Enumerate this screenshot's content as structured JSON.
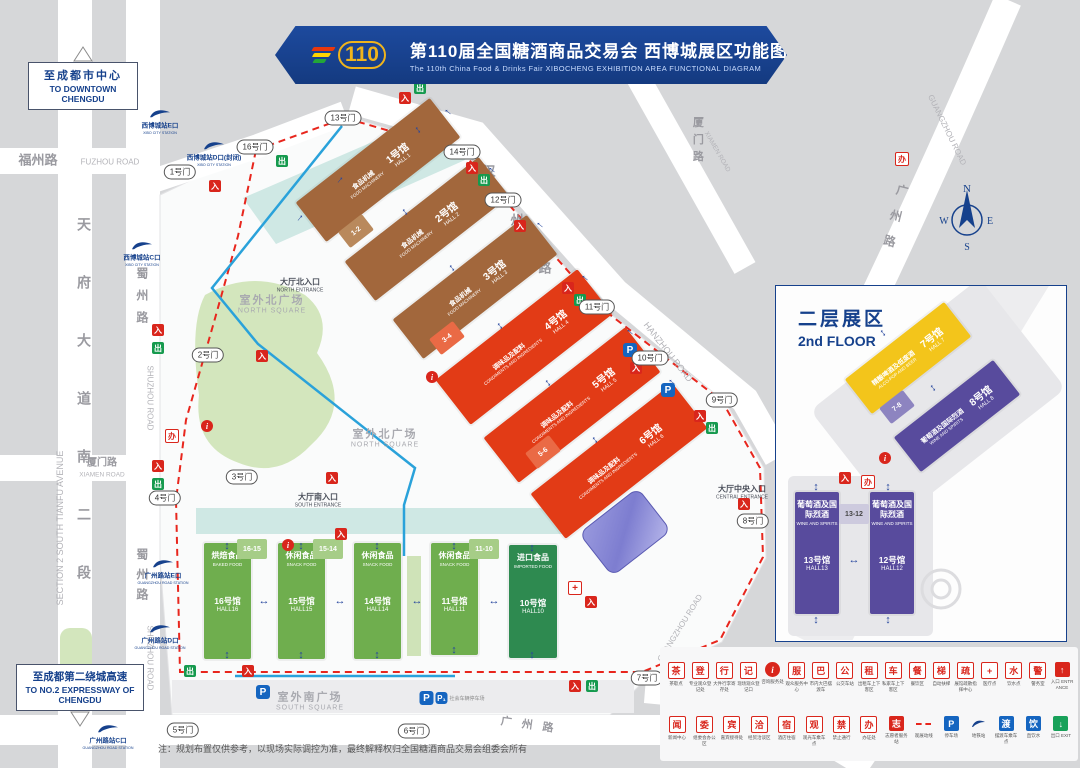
{
  "title": {
    "logo": "110",
    "cn": "第110届全国糖酒商品交易会 西博城展区功能图",
    "en": "The 110th China Food & Drinks Fair  XIBOCHENG EXHIBITION AREA FUNCTIONAL DIAGRAM"
  },
  "callouts": {
    "downtown": {
      "cn": "至成都市中心",
      "en": "TO DOWNTOWN CHENGDU"
    },
    "expressway": {
      "cn": "至成都第二绕城高速",
      "en": "TO NO.2 EXPRESSWAY OF CHENGDU"
    }
  },
  "inset": {
    "title_cn": "二层展区",
    "title_en": "2nd FLOOR"
  },
  "note": "注：规划布置仅供参考，以现场实际调控为准，最终解释权归全国糖酒商品交易会组委会所有",
  "compass": {
    "n": "N",
    "e": "E",
    "s": "S",
    "w": "W"
  },
  "colors": {
    "brand_blue": "#16418c",
    "route_red": "#e8261d",
    "metro_blue": "#2aa2da",
    "hall_brown": "#a2673c",
    "hall_red": "#e23b16",
    "hall_green": "#6fae4e",
    "hall_dark_green": "#2e8a50",
    "hall_yellow": "#f3c51b",
    "hall_purple": "#584b9d"
  },
  "halls": {
    "rotated": [
      {
        "num_cn": "1号馆",
        "num_en": "HALL 1",
        "cat_cn": "食品机械",
        "cat_en": "FOOD MACHINERY",
        "x": 378,
        "y": 170,
        "w": 170,
        "h": 50,
        "bg": "#a2673c",
        "r": -38
      },
      {
        "num_cn": "2号馆",
        "num_en": "HALL 2",
        "cat_cn": "食品机械",
        "cat_en": "FOOD MACHINERY",
        "x": 427,
        "y": 229,
        "w": 170,
        "h": 50,
        "bg": "#a2673c",
        "r": -38
      },
      {
        "num_cn": "3号馆",
        "num_en": "HALL 3",
        "cat_cn": "食品机械",
        "cat_en": "FOOD MACHINERY",
        "x": 475,
        "y": 287,
        "w": 170,
        "h": 50,
        "bg": "#a2673c",
        "r": -38
      },
      {
        "num_cn": "4号馆",
        "num_en": "HALL 4",
        "cat_cn": "调味品及配料",
        "cat_en": "CONDIMENTS AND INGREDIENTS",
        "x": 524,
        "y": 347,
        "w": 180,
        "h": 57,
        "bg": "#e23b16",
        "r": -38
      },
      {
        "num_cn": "5号馆",
        "num_en": "HALL 5",
        "cat_cn": "调味品及配料",
        "cat_en": "CONDIMENTS AND INGREDIENTS",
        "x": 572,
        "y": 405,
        "w": 180,
        "h": 57,
        "bg": "#e23b16",
        "r": -38
      },
      {
        "num_cn": "6号馆",
        "num_en": "HALL 6",
        "cat_cn": "调味品及配料",
        "cat_en": "CONDIMENTS AND INGREDIENTS",
        "x": 619,
        "y": 461,
        "w": 180,
        "h": 57,
        "bg": "#e23b16",
        "r": -38
      },
      {
        "num_cn": "7号馆",
        "num_en": "HALL 7",
        "cat_cn": "精酿啤酒及低度酒",
        "cat_en": "ALCO-POP AND BEER",
        "x": 908,
        "y": 358,
        "w": 126,
        "h": 44,
        "bg": "#f3c51b",
        "r": -38
      },
      {
        "num_cn": "8号馆",
        "num_en": "HALL 8",
        "cat_cn": "葡萄酒及国际烈酒",
        "cat_en": "WINE AND SPIRITS",
        "x": 957,
        "y": 416,
        "w": 126,
        "h": 44,
        "bg": "#584b9d",
        "r": -38
      }
    ],
    "green": [
      {
        "num_cn": "16号馆",
        "num_en": "HALL16",
        "cat_cn": "烘焙食品",
        "cat_en": "BAKED FOOD",
        "x": 204,
        "y": 543,
        "w": 47,
        "h": 116,
        "bg": "#6fae4e"
      },
      {
        "num_cn": "15号馆",
        "num_en": "HALL15",
        "cat_cn": "休闲食品",
        "cat_en": "SNACK FOOD",
        "x": 278,
        "y": 543,
        "w": 47,
        "h": 116,
        "bg": "#6fae4e"
      },
      {
        "num_cn": "14号馆",
        "num_en": "HALL14",
        "cat_cn": "休闲食品",
        "cat_en": "SNACK FOOD",
        "x": 354,
        "y": 543,
        "w": 47,
        "h": 116,
        "bg": "#6fae4e"
      },
      {
        "num_cn": "11号馆",
        "num_en": "HALL11",
        "cat_cn": "休闲食品",
        "cat_en": "SNACK FOOD",
        "x": 431,
        "y": 543,
        "w": 47,
        "h": 112,
        "bg": "#6fae4e"
      },
      {
        "num_cn": "10号馆",
        "num_en": "HALL10",
        "cat_cn": "进口食品",
        "cat_en": "IMPORTED FOOD",
        "x": 509,
        "y": 545,
        "w": 48,
        "h": 113,
        "bg": "#2e8a50"
      }
    ],
    "inset_vertical": [
      {
        "num_cn": "13号馆",
        "num_en": "HALL13",
        "cat_cn": "葡萄酒及国际烈酒",
        "cat_en": "WINE AND SPIRITS",
        "x": 795,
        "y": 492,
        "w": 44,
        "h": 122,
        "bg": "#584b9d"
      },
      {
        "num_cn": "12号馆",
        "num_en": "HALL12",
        "cat_cn": "葡萄酒及国际烈酒",
        "cat_en": "WINE AND SPIRITS",
        "x": 870,
        "y": 492,
        "w": 44,
        "h": 122,
        "bg": "#584b9d"
      }
    ],
    "connectors": [
      {
        "t": "1-2",
        "x": 356,
        "y": 231,
        "r": -38,
        "bg": "#b9895c",
        "c": "#ffffff"
      },
      {
        "t": "3-4",
        "x": 447,
        "y": 338,
        "r": -38,
        "bg": "#ea6a45",
        "c": "#ffffff"
      },
      {
        "t": "5-6",
        "x": 543,
        "y": 452,
        "r": -38,
        "bg": "#ea6a45",
        "c": "#ffffff"
      },
      {
        "t": "7-8",
        "x": 897,
        "y": 407,
        "r": -38,
        "bg": "#8d84c0",
        "c": "#ffffff"
      },
      {
        "t": "16-15",
        "x": 252,
        "y": 549,
        "r": 0,
        "bg": "#a6cd87",
        "c": "#ffffff"
      },
      {
        "t": "15-14",
        "x": 328,
        "y": 549,
        "r": 0,
        "bg": "#a6cd87",
        "c": "#ffffff"
      },
      {
        "t": "11-10",
        "x": 484,
        "y": 549,
        "r": 0,
        "bg": "#a6cd87",
        "c": "#ffffff"
      },
      {
        "t": "13-12",
        "x": 854,
        "y": 514,
        "r": 0,
        "bg": "#cdcade",
        "c": "#454545"
      }
    ]
  },
  "gates": [
    {
      "t": "1号门",
      "x": 180,
      "y": 172
    },
    {
      "t": "2号门",
      "x": 208,
      "y": 355
    },
    {
      "t": "3号门",
      "x": 242,
      "y": 477
    },
    {
      "t": "4号门",
      "x": 165,
      "y": 498
    },
    {
      "t": "5号门",
      "x": 183,
      "y": 730
    },
    {
      "t": "6号门",
      "x": 414,
      "y": 731
    },
    {
      "t": "7号门",
      "x": 647,
      "y": 678
    },
    {
      "t": "8号门",
      "x": 753,
      "y": 521
    },
    {
      "t": "9号门",
      "x": 722,
      "y": 400
    },
    {
      "t": "10号门",
      "x": 650,
      "y": 358
    },
    {
      "t": "11号门",
      "x": 597,
      "y": 307
    },
    {
      "t": "12号门",
      "x": 503,
      "y": 200
    },
    {
      "t": "13号门",
      "x": 343,
      "y": 118
    },
    {
      "t": "14号门",
      "x": 462,
      "y": 152
    },
    {
      "t": "16号门",
      "x": 255,
      "y": 147
    }
  ],
  "metro_stations": [
    {
      "cn": "西博城站E口",
      "en": "XIBO CITY STATION",
      "x": 160,
      "y": 120
    },
    {
      "cn": "西博城站D口(封闭)",
      "en": "XIBO CITY STATION",
      "x": 214,
      "y": 152
    },
    {
      "cn": "西博城站C口",
      "en": "XIBO CITY STATION",
      "x": 142,
      "y": 252
    },
    {
      "cn": "广州路站E口",
      "en": "GUANGZHOU ROAD STATION",
      "x": 163,
      "y": 570
    },
    {
      "cn": "广州路站D口",
      "en": "GUANGZHOU ROAD STATION",
      "x": 160,
      "y": 635
    },
    {
      "cn": "广州路站C口",
      "en": "GUANGZHOU ROAD STATION",
      "x": 108,
      "y": 735
    }
  ],
  "parking": [
    {
      "t": "P",
      "x": 630,
      "y": 350
    },
    {
      "t": "P",
      "x": 668,
      "y": 390
    },
    {
      "t": "P",
      "x": 263,
      "y": 692
    },
    {
      "t": "P",
      "t2": "P₁",
      "extra": "社会车辆停车场",
      "x": 452,
      "y": 698
    }
  ],
  "squares": [
    {
      "cn": "室外北广场",
      "en": "NORTH SQUARE",
      "x": 272,
      "y": 303
    },
    {
      "cn": "室外北广场",
      "en": "NORTH SQUARE",
      "x": 385,
      "y": 437
    },
    {
      "cn": "室外南广场",
      "en": "SOUTH SQUARE",
      "x": 310,
      "y": 700
    }
  ],
  "entrances": [
    {
      "cn": "大厅北入口",
      "en": "NORTH ENTRANCE",
      "x": 300,
      "y": 285
    },
    {
      "cn": "大厅南入口",
      "en": "SOUTH ENTRANCE",
      "x": 318,
      "y": 500
    },
    {
      "cn": "大厅中央入口",
      "en": "CENTRAL ENTRANCE",
      "x": 742,
      "y": 492
    }
  ],
  "labels": [
    {
      "t": "福州路",
      "x": 38,
      "y": 161,
      "s": 13,
      "c": "#9a9aa0",
      "b": 1
    },
    {
      "t": "FUZHOU ROAD",
      "x": 110,
      "y": 162,
      "s": 8,
      "c": "#b3b3b8"
    },
    {
      "t": "天府大道南二段",
      "x": 84,
      "y": 420,
      "s": 14,
      "c": "#9a9aa0",
      "b": 1,
      "v": 1,
      "ls": 44
    },
    {
      "t": "SECTION 2 SOUTH TIANFU AVENUE",
      "x": 60,
      "y": 528,
      "s": 9,
      "c": "#b3b3b8",
      "r": -90
    },
    {
      "t": "蜀州路",
      "x": 141,
      "y": 300,
      "s": 12,
      "c": "#9a9aa0",
      "b": 1,
      "v": 1,
      "ls": 10
    },
    {
      "t": "SHUZHOU ROAD",
      "x": 150,
      "y": 398,
      "s": 8,
      "c": "#b3b3b8",
      "r": 90
    },
    {
      "t": "蜀州路",
      "x": 141,
      "y": 578,
      "s": 12,
      "c": "#9a9aa0",
      "b": 1,
      "v": 1,
      "ls": 8
    },
    {
      "t": "SHUZHOU ROAD",
      "x": 150,
      "y": 658,
      "s": 8,
      "c": "#b3b3b8",
      "r": 90
    },
    {
      "t": "厦门路",
      "x": 102,
      "y": 463,
      "s": 10,
      "c": "#9a9aa0",
      "b": 1
    },
    {
      "t": "XIAMEN ROAD",
      "x": 102,
      "y": 475,
      "s": 6.5,
      "c": "#b3b3b8"
    },
    {
      "t": "厦门路",
      "x": 697,
      "y": 142,
      "s": 11,
      "c": "#9a9aa0",
      "b": 1,
      "v": 1,
      "ls": 6
    },
    {
      "t": "XIAMEN ROAD",
      "x": 717,
      "y": 152,
      "s": 6.5,
      "c": "#b3b3b8",
      "r": 60
    },
    {
      "t": "汉",
      "x": 489,
      "y": 172,
      "s": 13,
      "c": "#9a9aa0",
      "b": 1
    },
    {
      "t": "州",
      "x": 517,
      "y": 221,
      "s": 13,
      "c": "#9a9aa0",
      "b": 1
    },
    {
      "t": "路",
      "x": 545,
      "y": 269,
      "s": 13,
      "c": "#9a9aa0",
      "b": 1
    },
    {
      "t": "HANZHOU ROAD",
      "x": 668,
      "y": 352,
      "s": 9,
      "c": "#b3b3b8",
      "r": 52
    },
    {
      "t": "广州路",
      "x": 893,
      "y": 222,
      "s": 12,
      "c": "#9a9aa0",
      "b": 1,
      "v": 1,
      "ls": 14,
      "r": 14
    },
    {
      "t": "GUANGZHOU ROAD",
      "x": 947,
      "y": 130,
      "s": 8,
      "c": "#b3b3b8",
      "r": 64
    },
    {
      "t": "GUANGZHOU ROAD",
      "x": 680,
      "y": 628,
      "s": 8,
      "c": "#b3b3b8",
      "r": -58
    },
    {
      "t": "广州路",
      "x": 532,
      "y": 726,
      "s": 11,
      "c": "#9a9aa0",
      "b": 1,
      "ls": 10,
      "r": 8
    },
    {
      "t": "GUANGZHOU ROAD",
      "x": 706,
      "y": 712,
      "s": 7,
      "c": "#b3b3b8",
      "r": 20
    }
  ],
  "mini_icons": [
    {
      "k": "red",
      "x": 215,
      "y": 186
    },
    {
      "k": "green",
      "x": 282,
      "y": 161
    },
    {
      "k": "red",
      "x": 158,
      "y": 330
    },
    {
      "k": "green",
      "x": 158,
      "y": 348
    },
    {
      "k": "red",
      "x": 158,
      "y": 466
    },
    {
      "k": "green",
      "x": 158,
      "y": 484
    },
    {
      "k": "ban",
      "x": 172,
      "y": 436
    },
    {
      "k": "info",
      "x": 207,
      "y": 426
    },
    {
      "k": "red",
      "x": 262,
      "y": 356
    },
    {
      "k": "red",
      "x": 332,
      "y": 478
    },
    {
      "k": "info",
      "x": 288,
      "y": 545
    },
    {
      "k": "red",
      "x": 341,
      "y": 534
    },
    {
      "k": "info",
      "x": 432,
      "y": 377
    },
    {
      "k": "red",
      "x": 472,
      "y": 168
    },
    {
      "k": "green",
      "x": 484,
      "y": 180
    },
    {
      "k": "red",
      "x": 520,
      "y": 226
    },
    {
      "k": "red",
      "x": 568,
      "y": 288
    },
    {
      "k": "green",
      "x": 580,
      "y": 300
    },
    {
      "k": "red",
      "x": 636,
      "y": 368
    },
    {
      "k": "red",
      "x": 700,
      "y": 416
    },
    {
      "k": "green",
      "x": 712,
      "y": 428
    },
    {
      "k": "red",
      "x": 744,
      "y": 504
    },
    {
      "k": "cross",
      "x": 575,
      "y": 588
    },
    {
      "k": "red",
      "x": 591,
      "y": 602
    },
    {
      "k": "red",
      "x": 575,
      "y": 686
    },
    {
      "k": "green",
      "x": 592,
      "y": 686
    },
    {
      "k": "ban",
      "x": 902,
      "y": 159
    },
    {
      "k": "info",
      "x": 885,
      "y": 458
    },
    {
      "k": "red",
      "x": 845,
      "y": 478
    },
    {
      "k": "ban",
      "x": 868,
      "y": 482
    },
    {
      "k": "red",
      "x": 405,
      "y": 98
    },
    {
      "k": "green",
      "x": 420,
      "y": 88
    },
    {
      "k": "green",
      "x": 190,
      "y": 671
    },
    {
      "k": "red",
      "x": 248,
      "y": 671
    }
  ],
  "arrows": [
    {
      "g": "↑",
      "x": 492,
      "y": 170,
      "r": -50
    },
    {
      "g": "↑",
      "x": 540,
      "y": 225,
      "r": -50
    },
    {
      "g": "↑",
      "x": 585,
      "y": 278,
      "r": -50
    },
    {
      "g": "↑",
      "x": 630,
      "y": 332,
      "r": -50
    },
    {
      "g": "↑",
      "x": 672,
      "y": 382,
      "r": -50
    },
    {
      "g": "↕",
      "x": 405,
      "y": 212,
      "r": -38
    },
    {
      "g": "↕",
      "x": 452,
      "y": 268,
      "r": -38
    },
    {
      "g": "↕",
      "x": 500,
      "y": 326,
      "r": -38
    },
    {
      "g": "↕",
      "x": 548,
      "y": 383,
      "r": -38
    },
    {
      "g": "↕",
      "x": 595,
      "y": 440,
      "r": -38
    },
    {
      "g": "↑",
      "x": 300,
      "y": 218,
      "r": 40
    },
    {
      "g": "↑",
      "x": 340,
      "y": 180,
      "r": 40
    },
    {
      "g": "↕",
      "x": 227,
      "y": 546,
      "r": 0
    },
    {
      "g": "↕",
      "x": 227,
      "y": 655,
      "r": 0
    },
    {
      "g": "↕",
      "x": 301,
      "y": 546,
      "r": 0
    },
    {
      "g": "↕",
      "x": 301,
      "y": 655,
      "r": 0
    },
    {
      "g": "↕",
      "x": 377,
      "y": 546,
      "r": 0
    },
    {
      "g": "↕",
      "x": 377,
      "y": 655,
      "r": 0
    },
    {
      "g": "↕",
      "x": 454,
      "y": 546,
      "r": 0
    },
    {
      "g": "↕",
      "x": 454,
      "y": 650,
      "r": 0
    },
    {
      "g": "↕",
      "x": 532,
      "y": 548,
      "r": 0
    },
    {
      "g": "↕",
      "x": 532,
      "y": 655,
      "r": 0
    },
    {
      "g": "↔",
      "x": 264,
      "y": 601,
      "r": 0
    },
    {
      "g": "↔",
      "x": 340,
      "y": 601,
      "r": 0
    },
    {
      "g": "↔",
      "x": 417,
      "y": 601,
      "r": 0
    },
    {
      "g": "↔",
      "x": 494,
      "y": 601,
      "r": 0
    },
    {
      "g": "↕",
      "x": 883,
      "y": 333,
      "r": -38
    },
    {
      "g": "↕",
      "x": 933,
      "y": 388,
      "r": -38
    },
    {
      "g": "↕",
      "x": 816,
      "y": 487,
      "r": 0
    },
    {
      "g": "↕",
      "x": 888,
      "y": 487,
      "r": 0
    },
    {
      "g": "↕",
      "x": 816,
      "y": 620,
      "r": 0
    },
    {
      "g": "↕",
      "x": 888,
      "y": 620,
      "r": 0
    },
    {
      "g": "↔",
      "x": 854,
      "y": 560,
      "r": 0
    },
    {
      "g": "↕",
      "x": 418,
      "y": 130,
      "r": -38
    },
    {
      "g": "↑",
      "x": 448,
      "y": 112,
      "r": -50
    }
  ],
  "legend": {
    "rows": [
      [
        {
          "t": "茶歇点",
          "k": "box",
          "g": "茶"
        },
        {
          "t": "专业观众登记处",
          "k": "box",
          "g": "登"
        },
        {
          "t": "大件行李寄存处",
          "k": "box",
          "g": "行"
        },
        {
          "t": "现场观众登记口",
          "k": "box",
          "g": "记"
        },
        {
          "t": "咨询服务处",
          "k": "info",
          "g": "i"
        },
        {
          "t": "观众服务中心",
          "k": "box",
          "g": "服"
        },
        {
          "t": "市内大巴摆渡车",
          "k": "box",
          "g": "巴"
        },
        {
          "t": "公交车站",
          "k": "box",
          "g": "公"
        },
        {
          "t": "出租车上下客区",
          "k": "box",
          "g": "租"
        },
        {
          "t": "私家车上下客区",
          "k": "box",
          "g": "车"
        },
        {
          "t": "餐饮区",
          "k": "box",
          "g": "餐"
        },
        {
          "t": "自动扶梯",
          "k": "box",
          "g": "梯"
        },
        {
          "t": "展馆疏散指挥中心",
          "k": "box",
          "g": "疏"
        },
        {
          "t": "医疗点",
          "k": "box",
          "g": "+"
        },
        {
          "t": "饮水点",
          "k": "box",
          "g": "水"
        },
        {
          "t": "警务室",
          "k": "box",
          "g": "警"
        },
        {
          "t": "入口 ENTRANCE",
          "k": "red",
          "g": "↑"
        }
      ],
      [
        {
          "t": "新闻中心",
          "k": "box",
          "g": "闻"
        },
        {
          "t": "组委会办公区",
          "k": "box",
          "g": "委"
        },
        {
          "t": "嘉宾接待处",
          "k": "box",
          "g": "宾"
        },
        {
          "t": "经贸洽谈区",
          "k": "box",
          "g": "洽"
        },
        {
          "t": "酒店住宿",
          "k": "box",
          "g": "宿"
        },
        {
          "t": "观光车乘车点",
          "k": "box",
          "g": "观"
        },
        {
          "t": "禁止通行",
          "k": "box",
          "g": "禁"
        },
        {
          "t": "办证处",
          "k": "box",
          "g": "办"
        },
        {
          "t": "志愿者服务站",
          "k": "red",
          "g": "志"
        },
        {
          "t": "观展动线",
          "k": "dash"
        },
        {
          "t": "停车场",
          "k": "blue",
          "g": "P"
        },
        {
          "t": "地铁站",
          "k": "metro"
        },
        {
          "t": "摆渡车乘车点",
          "k": "blue",
          "g": "渡"
        },
        {
          "t": "直饮水",
          "k": "blue",
          "g": "饮"
        },
        {
          "t": "出口 EXIT",
          "k": "green",
          "g": "↓"
        }
      ]
    ]
  }
}
